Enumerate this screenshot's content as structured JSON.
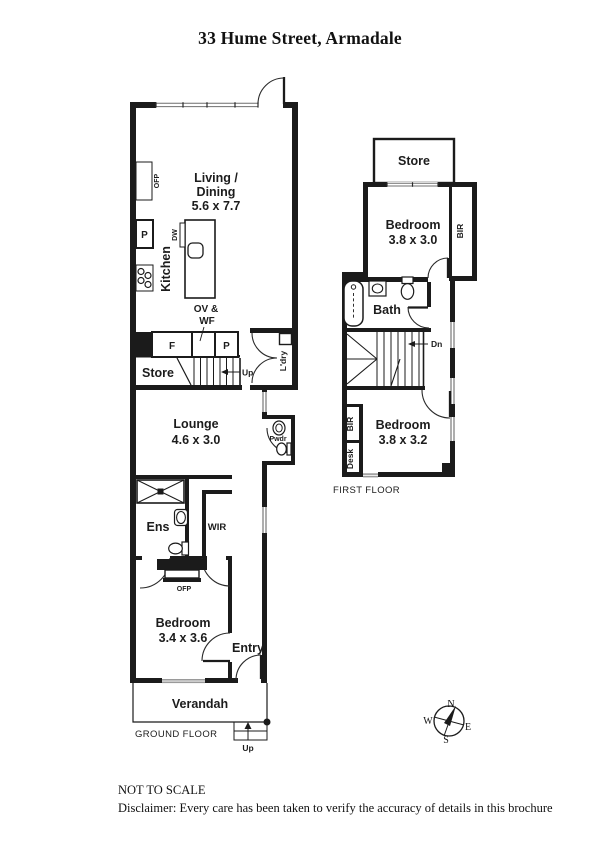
{
  "title": "33 Hume Street, Armadale",
  "ground_floor": {
    "caption": "GROUND FLOOR",
    "living_line1": "Living /",
    "living_line2": "Dining",
    "living_dims": "5.6 x 7.7",
    "kitchen": "Kitchen",
    "ofp_living": "OFP",
    "pantry_upper": "P",
    "dishwasher": "DW",
    "oven_line1": "OV &",
    "oven_line2": "WF",
    "fridge": "F",
    "pantry_lower": "P",
    "store": "Store",
    "stairs_up": "Up",
    "laundry": "L'dry",
    "lounge": "Lounge",
    "lounge_dims": "4.6 x 3.0",
    "powder": "Pwdr",
    "ensuite": "Ens",
    "wir": "WIR",
    "ofp_bedroom": "OFP",
    "bedroom": "Bedroom",
    "bedroom_dims": "3.4 x 3.6",
    "entry": "Entry",
    "verandah": "Verandah",
    "steps_up": "Up"
  },
  "first_floor": {
    "caption": "FIRST FLOOR",
    "store": "Store",
    "bedroom1": "Bedroom",
    "bedroom1_dims": "3.8 x 3.0",
    "bir1": "BIR",
    "bath": "Bath",
    "stairs_down": "Dn",
    "bir2": "BIR",
    "desk": "Desk",
    "bedroom2": "Bedroom",
    "bedroom2_dims": "3.8 x 3.2"
  },
  "compass": {
    "north": "N",
    "south": "S",
    "east": "E",
    "west": "W"
  },
  "footer": {
    "scale_note": "NOT TO SCALE",
    "disclaimer": "Disclaimer: Every care has been taken to verify the accuracy of details in this brochure"
  },
  "colors": {
    "ink": "#1b1b1b",
    "window_grey": "#9a9a9a",
    "paper": "#ffffff"
  }
}
